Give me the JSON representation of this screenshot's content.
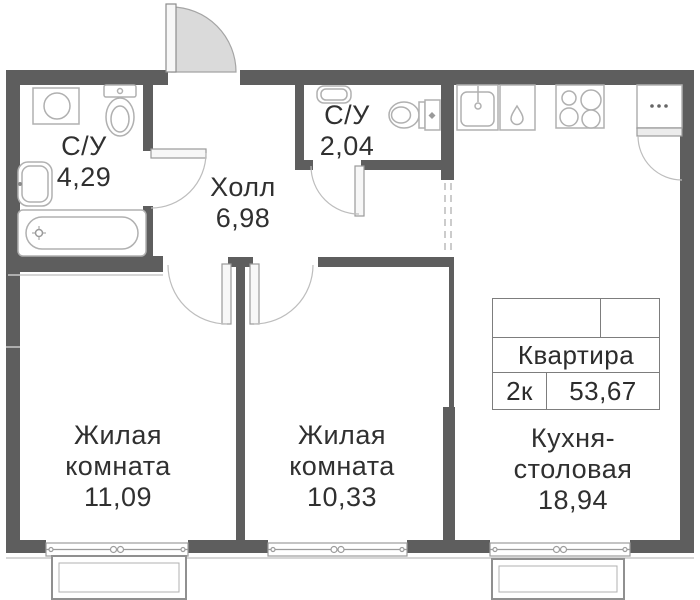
{
  "plan": {
    "background": "#ffffff",
    "wall_color": "#5e5e5e",
    "fixture_line_color": "#b0b0b0",
    "door_arc_color": "#bdbdbd",
    "text_color": "#303030"
  },
  "rooms": [
    {
      "id": "bathroom-1",
      "name": "С/У",
      "area": "4,29"
    },
    {
      "id": "bathroom-2",
      "name": "С/У",
      "area": "2,04"
    },
    {
      "id": "hall",
      "name": "Холл",
      "area": "6,98"
    },
    {
      "id": "living-room-1",
      "name": "Жилая комната",
      "area": "11,09"
    },
    {
      "id": "living-room-2",
      "name": "Жилая комната",
      "area": "10,33"
    },
    {
      "id": "kitchen-dining",
      "name": "Кухня-столовая",
      "area": "18,94"
    }
  ],
  "info_table": {
    "title": "Квартира",
    "rooms_label": "2к",
    "total_area": "53,67"
  },
  "icons": [
    "washing-machine-icon",
    "toilet-icon",
    "sink-icon",
    "bathtub-icon",
    "toilet-2-icon",
    "sink-2-icon",
    "kitchen-sink-icon",
    "dishwasher-icon",
    "stove-icon",
    "fridge-icon",
    "entrance-door-icon",
    "window-icon",
    "balcony-icon"
  ]
}
